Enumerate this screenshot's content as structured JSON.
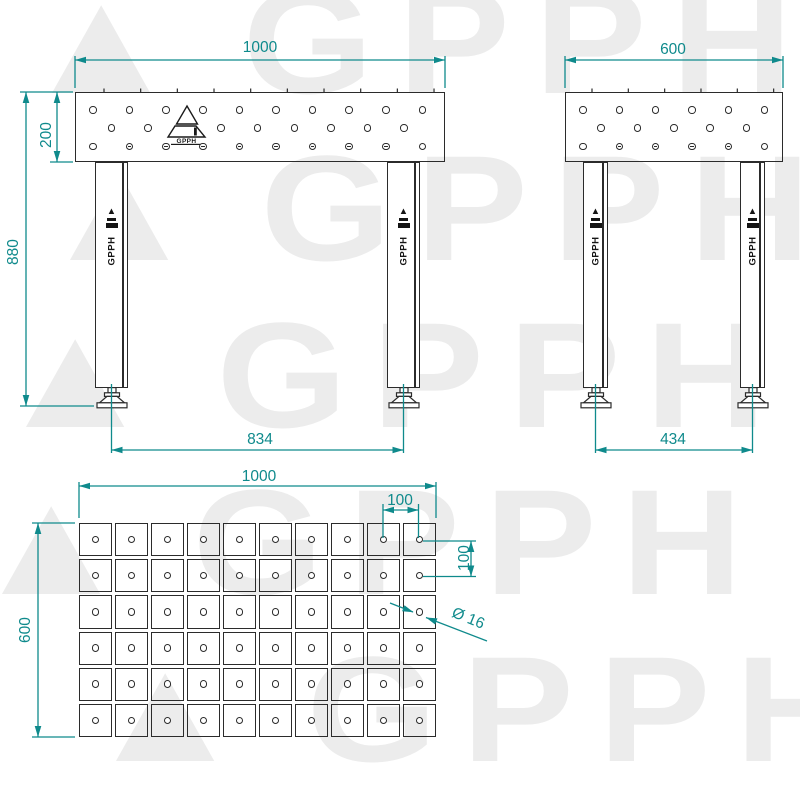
{
  "brand": "GPPH",
  "watermark": {
    "symbol": "▲",
    "text": "GPPH",
    "color": "#ececec"
  },
  "colors": {
    "dimension": "#0f8a8c",
    "line": "#2b2b2b"
  },
  "front_view": {
    "label": "front-view",
    "dim_width": "1000",
    "dim_top_height": "200",
    "dim_total_height": "880",
    "dim_foot_span": "834",
    "holes_per_row": [
      10,
      8,
      10
    ]
  },
  "side_view": {
    "label": "side-view",
    "dim_width": "600",
    "dim_foot_span": "434",
    "holes_per_row": [
      6,
      5,
      6
    ]
  },
  "top_view": {
    "label": "top-view",
    "dim_width": "1000",
    "dim_height": "600",
    "dim_spacing_x": "100",
    "dim_spacing_y": "100",
    "dim_hole_diameter": "Ø 16",
    "grid_cols": 10,
    "grid_rows": 6
  }
}
